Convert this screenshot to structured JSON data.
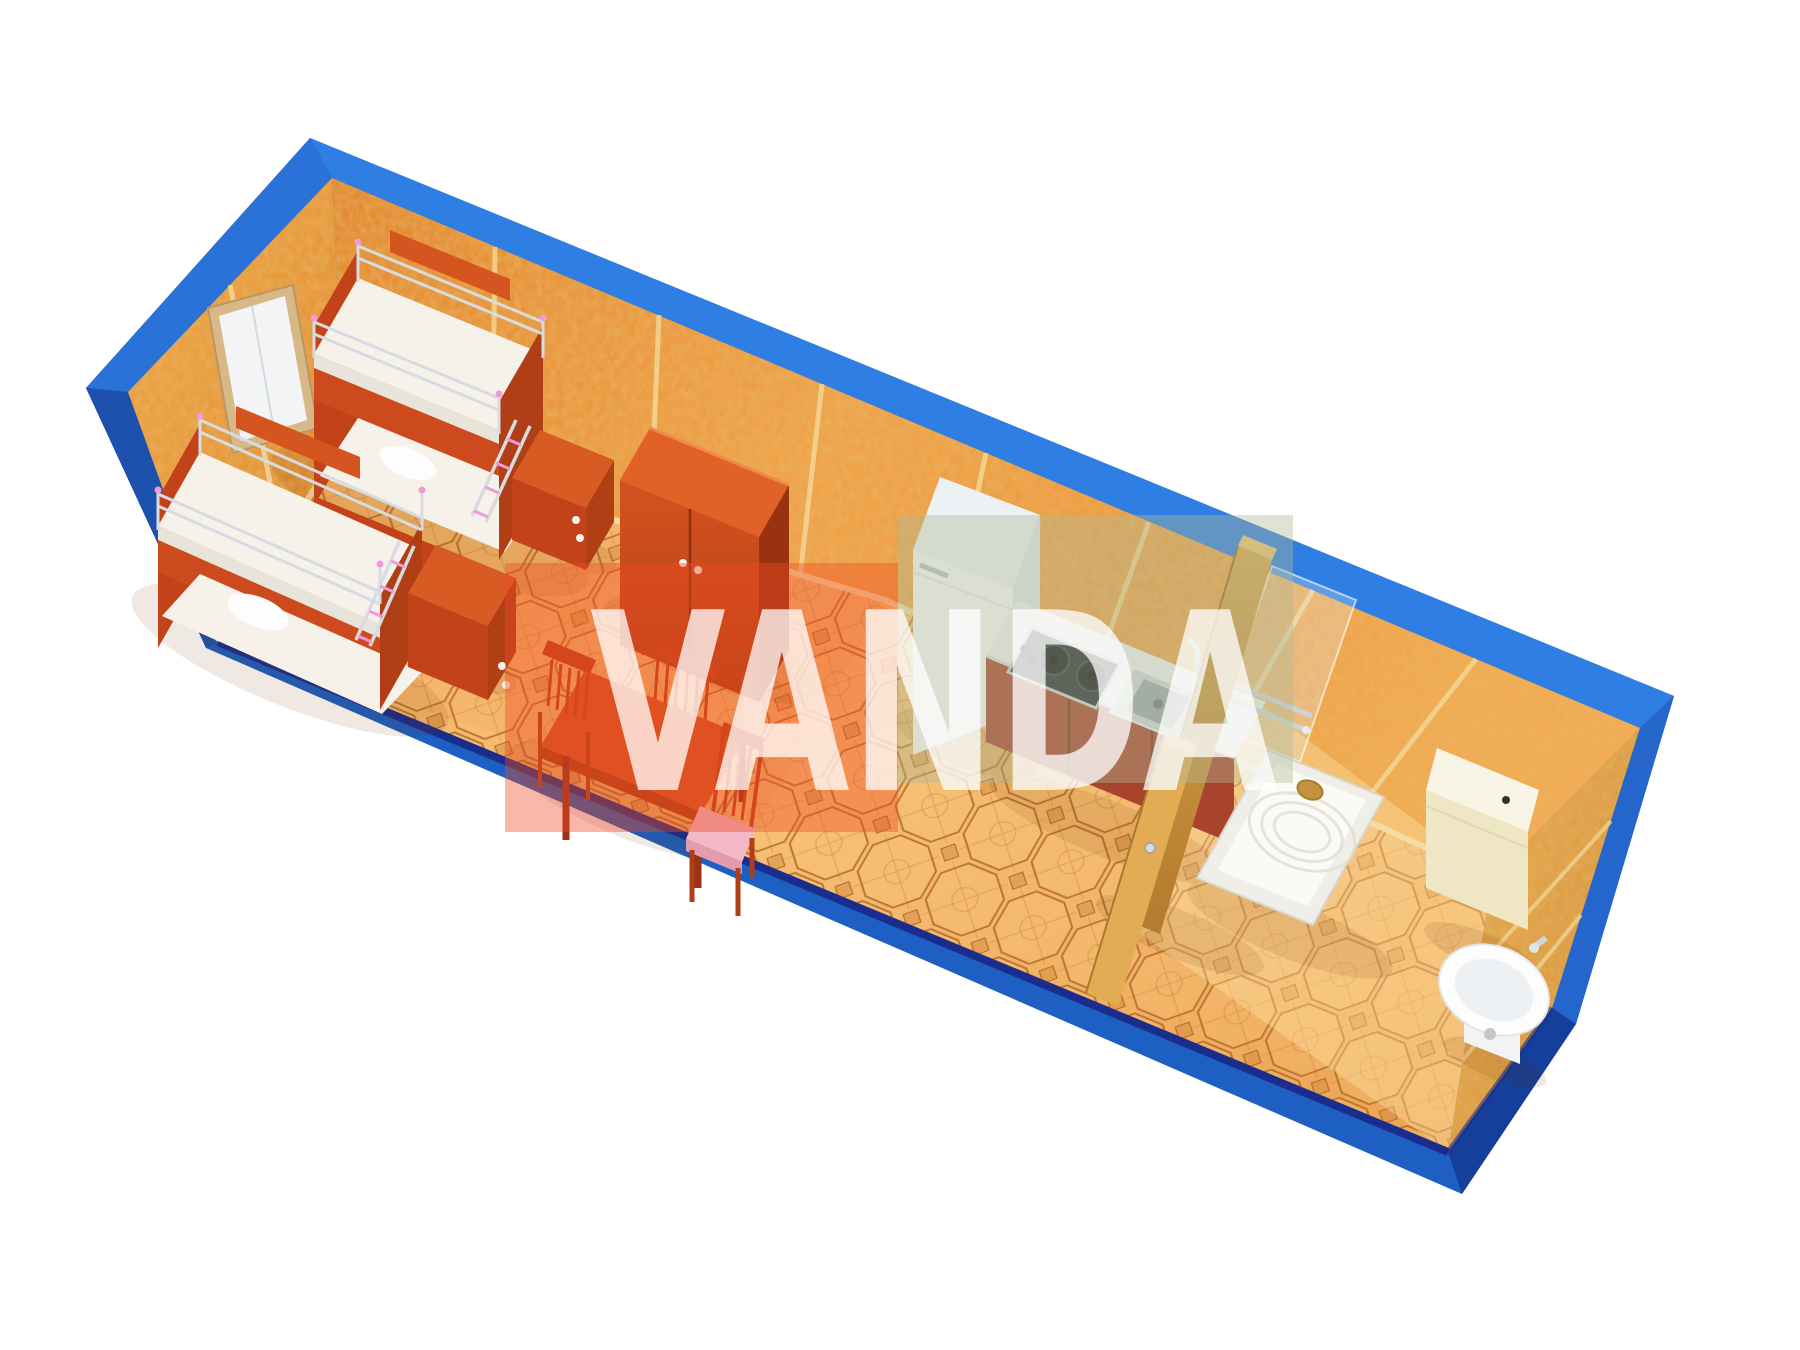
{
  "scene": {
    "description": "3D bird's-eye rendering of a blue container cabin interior floor plan",
    "background": "#ffffff",
    "width": 1800,
    "height": 1350
  },
  "watermark": {
    "text": "VANDA",
    "text_color": "#ffffff",
    "panel_warm": "rgba(240,75,35,0.40)",
    "panel_cool": "rgba(175,185,150,0.40)"
  },
  "colors": {
    "shell_blue": "#1d5fc2",
    "shell_blue_light": "#2f7ee3",
    "shell_blue_dark": "#153f9a",
    "navy_edge": "#1b2d8c",
    "wall_orange": "#e8943c",
    "wall_seam": "#f3d999",
    "floor_tile": "#f2b264",
    "floor_line": "#bd7733",
    "furniture_red": "#cc4a1d",
    "furniture_red_dark": "#b03f16",
    "mattress_white": "#f6f2ea",
    "appliance_white": "#f7f9fb",
    "steel_gray": "#cfd6db",
    "wood_partition": "#c8913f",
    "cream": "#efe7c4",
    "pink_accent": "#f09ad8",
    "cushion_pink": "#f2b8c6",
    "watermark_panel_warm": "rgba(240,75,35,0.40)",
    "watermark_panel_cool": "rgba(175,185,150,0.40)",
    "watermark_text_color": "#ffffff"
  },
  "objects": [
    "window",
    "bunk-bed-1",
    "bunk-bed-2",
    "nightstand-1",
    "nightstand-2",
    "dining-table",
    "chair-1",
    "chair-2",
    "chair-3",
    "wardrobe",
    "fridge",
    "kitchen-counter",
    "cooktop",
    "kitchen-sink",
    "partition-wall",
    "bathroom-door",
    "shower-glass",
    "shower-tray",
    "toilet",
    "wash-basin"
  ]
}
